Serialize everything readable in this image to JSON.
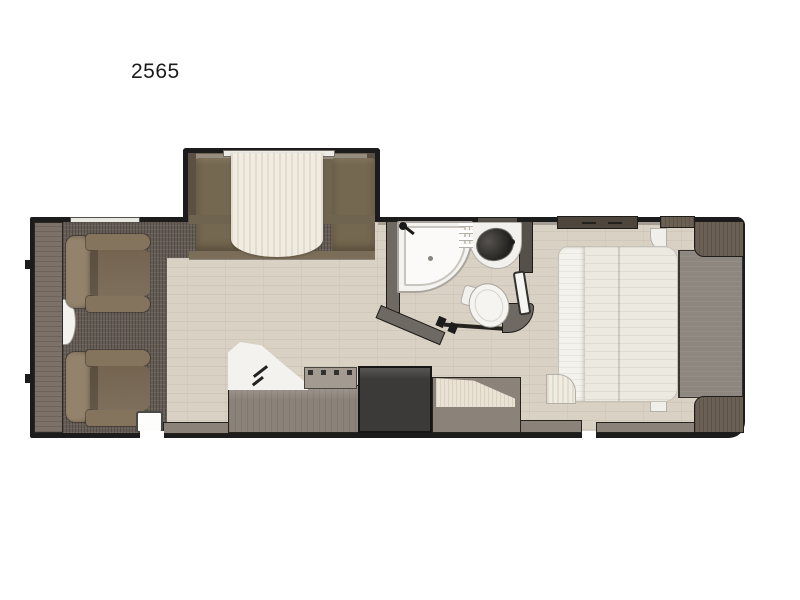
{
  "page": {
    "background": "#ffffff"
  },
  "floorplan": {
    "model_label": "2565",
    "type": "travel-trailer-floorplan",
    "colors": {
      "wall": "#1c1c1c",
      "floor": "#d8d1c4",
      "carpet": "#665e56",
      "chair": "#84745d",
      "sofa_slide": "#6f6450",
      "counter": "#f3f2ee",
      "refrigerator": "#3c3a38",
      "mattress": "#ece9e1",
      "bed_platform": "#8d8780",
      "wood_cabinet": "#6b6054"
    },
    "features": {
      "slide_out": {
        "label": "Sofa slide-out"
      },
      "slide_bed": {
        "label": "Murphy bed sofa"
      },
      "front_cabinet": {
        "label": "Front cabinet"
      },
      "side_table": {
        "label": "Side table"
      },
      "chair_front": {
        "label": "Theater seat (front)"
      },
      "chair_rear": {
        "label": "Theater seat (rear)"
      },
      "carpet": {
        "label": "Carpeted lounge area"
      },
      "entry_door": {
        "label": "Entry door"
      },
      "kitchen_counter": {
        "label": "Kitchen counter with sink"
      },
      "faucet": {
        "label": "Kitchen faucet"
      },
      "cooktop": {
        "label": "Cooktop range"
      },
      "refrigerator": {
        "label": "Refrigerator"
      },
      "kitchen_base": {
        "label": "Kitchen base cabinet"
      },
      "pantry": {
        "label": "Pantry cabinet"
      },
      "bathroom_door": {
        "label": "Bathroom door"
      },
      "shower": {
        "label": "Corner shower"
      },
      "shower_head": {
        "label": "Shower head"
      },
      "bath_sink": {
        "label": "Bathroom sink"
      },
      "toilet": {
        "label": "Toilet"
      },
      "bed": {
        "label": "Queen bed"
      },
      "bed_platform": {
        "label": "Bed platform"
      },
      "nightstand_front": {
        "label": "Nightstand (door side)"
      },
      "nightstand_rear": {
        "label": "Nightstand (rear corner)"
      },
      "overhead_cabinet": {
        "label": "Overhead cabinet"
      }
    }
  }
}
